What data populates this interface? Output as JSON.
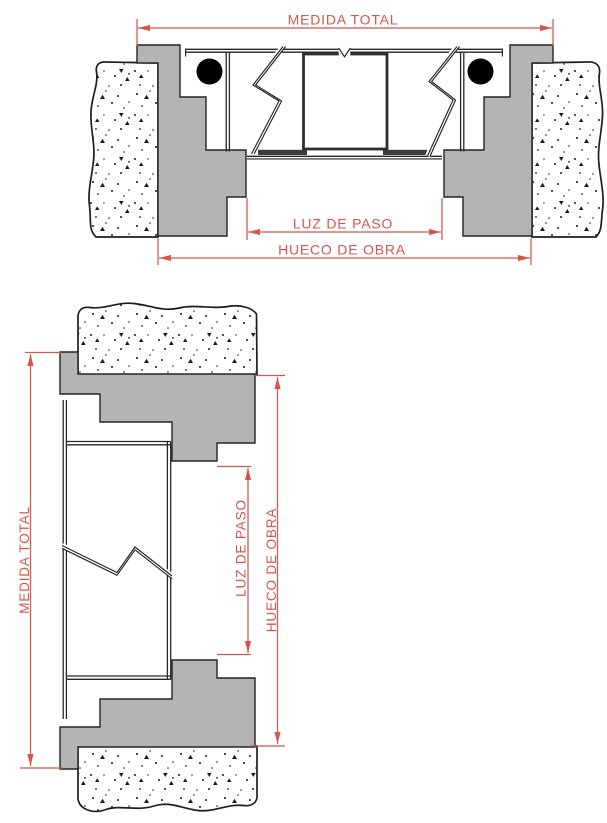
{
  "colors": {
    "dimension_red": "#d5564e",
    "frame_gray": "#b4b4b4",
    "line_dark": "#262626",
    "wall_fill": "#ffffff"
  },
  "top_view": {
    "labels": {
      "medida_total": "MEDIDA TOTAL",
      "luz_de_paso": "LUZ DE PASO",
      "hueco_de_obra": "HUECO DE OBRA"
    }
  },
  "bottom_view": {
    "labels": {
      "medida_total": "MEDIDA TOTAL",
      "luz_de_paso": "LUZ DE PASO",
      "hueco_de_obra": "HUECO DE OBRA"
    }
  }
}
